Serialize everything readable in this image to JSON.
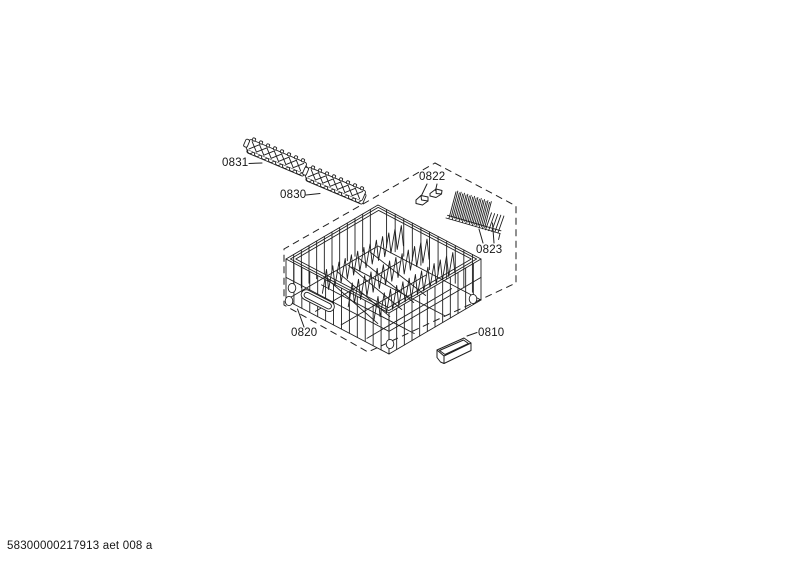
{
  "document": {
    "footer_code": "58300000217913 aet 008 a"
  },
  "diagram": {
    "type": "exploded-parts-diagram",
    "callouts": {
      "c0831": "0831",
      "c0830": "0830",
      "c0822": "0822",
      "c0823": "0823",
      "c0820": "0820",
      "c0810": "0810"
    },
    "line_color": "#1f1f1f",
    "background_color": "#ffffff"
  }
}
